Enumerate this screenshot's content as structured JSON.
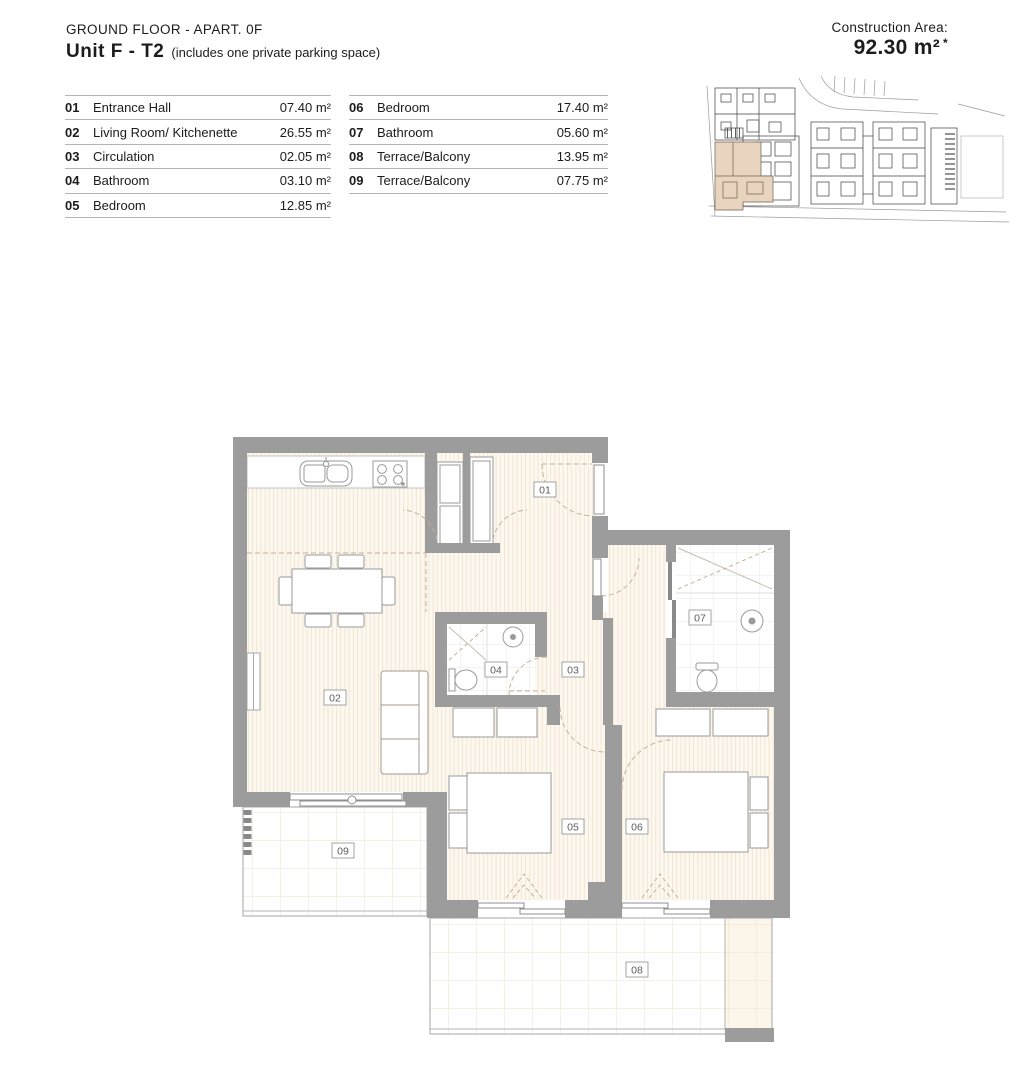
{
  "header": {
    "floor_label": "GROUND FLOOR - APART. 0F",
    "unit_name": "Unit F - T2",
    "unit_note": "(includes one private parking space)",
    "construction_area_label": "Construction Area:",
    "construction_area_value": "92.30 m²",
    "construction_area_suffix": "*"
  },
  "legend": {
    "left": [
      {
        "num": "01",
        "name": "Entrance Hall",
        "area": "07.40 m²"
      },
      {
        "num": "02",
        "name": "Living Room/ Kitchenette",
        "area": "26.55 m²"
      },
      {
        "num": "03",
        "name": "Circulation",
        "area": "02.05 m²"
      },
      {
        "num": "04",
        "name": "Bathroom",
        "area": "03.10 m²"
      },
      {
        "num": "05",
        "name": "Bedroom",
        "area": "12.85 m²"
      }
    ],
    "right": [
      {
        "num": "06",
        "name": "Bedroom",
        "area": "17.40 m²"
      },
      {
        "num": "07",
        "name": "Bathroom",
        "area": "05.60 m²"
      },
      {
        "num": "08",
        "name": "Terrace/Balcony",
        "area": "13.95 m²"
      },
      {
        "num": "09",
        "name": "Terrace/Balcony",
        "area": "07.75 m²"
      }
    ]
  },
  "plan": {
    "labels": {
      "r01": "01",
      "r02": "02",
      "r03": "03",
      "r04": "04",
      "r05": "05",
      "r06": "06",
      "r07": "07",
      "r08": "08",
      "r09": "09"
    }
  },
  "colors": {
    "wall": "#9c9c9c",
    "floor_stripe_bg": "#fcf8f0",
    "floor_stripe_line": "#f2e6d2",
    "terrace_grid_line": "#eee3cf",
    "bathroom_grid_line": "#e8e8e8",
    "door_swing_dash": "#c9b097",
    "fixture_line": "#9a9a9a",
    "site_plan_highlight": "#e9d5bf",
    "legend_rule": "#b5b5b5"
  }
}
